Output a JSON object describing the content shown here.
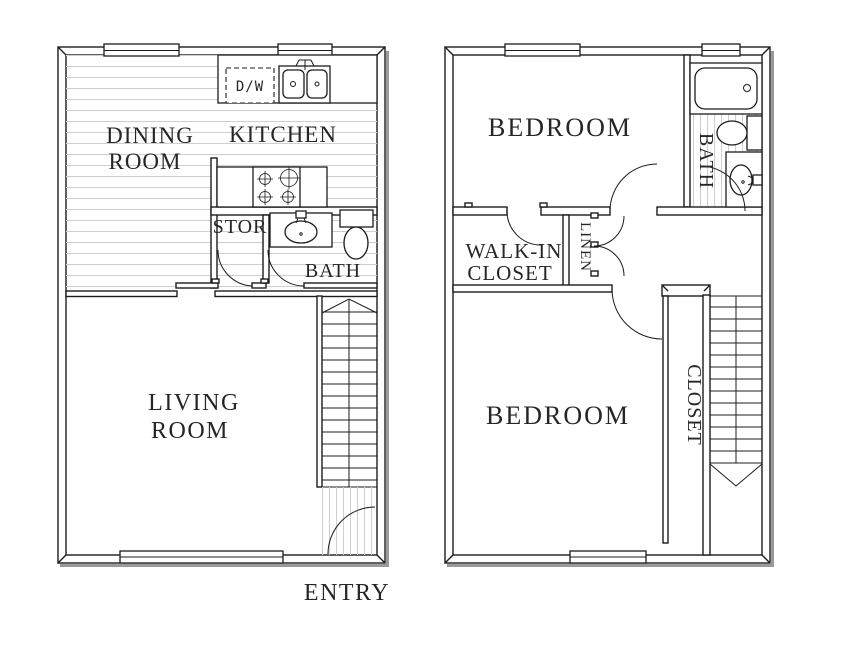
{
  "colors": {
    "line": "#1c1c1c",
    "hatch": "#cfcfcf",
    "shadow": "#9a9a9a",
    "text": "#262626",
    "background": "#ffffff"
  },
  "floor1": {
    "labels": {
      "dining_line1": "DINING",
      "dining_line2": "ROOM",
      "kitchen": "KITCHEN",
      "dishwasher": "D/W",
      "storage": "STOR",
      "bath": "BATH",
      "living_line1": "LIVING",
      "living_line2": "ROOM",
      "entry": "ENTRY"
    }
  },
  "floor2": {
    "labels": {
      "bedroom_upper": "BEDROOM",
      "bath": "BATH",
      "walkin_line1": "WALK-IN",
      "walkin_line2": "CLOSET",
      "linen": "LINEN",
      "bedroom_lower": "BEDROOM",
      "closet": "CLOSET"
    }
  }
}
